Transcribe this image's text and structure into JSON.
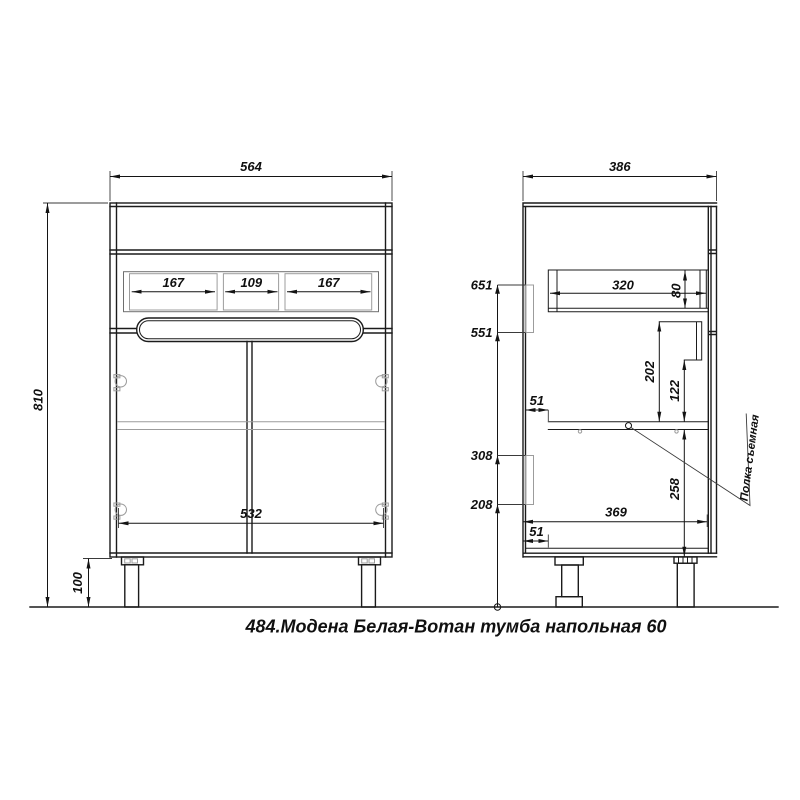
{
  "title": "484.Модена Белая-Вотан тумба напольная 60",
  "front_view": {
    "overall_width": "564",
    "overall_height": "810",
    "leg_height": "100",
    "interior_width": "532",
    "compartments": [
      "167",
      "109",
      "167"
    ]
  },
  "side_view": {
    "overall_depth": "386",
    "rail_heights": [
      "651",
      "551",
      "308",
      "208"
    ],
    "drawer_depth": "320",
    "drawer_height": "80",
    "runner_top_to_shelf": "202",
    "runner_bottom_to_shelf": "122",
    "shelf_to_bottom": "258",
    "interior_depth": "369",
    "shelf_front_gap": "51",
    "bottom_front_gap": "51",
    "shelf_note": "Полка съемная"
  }
}
